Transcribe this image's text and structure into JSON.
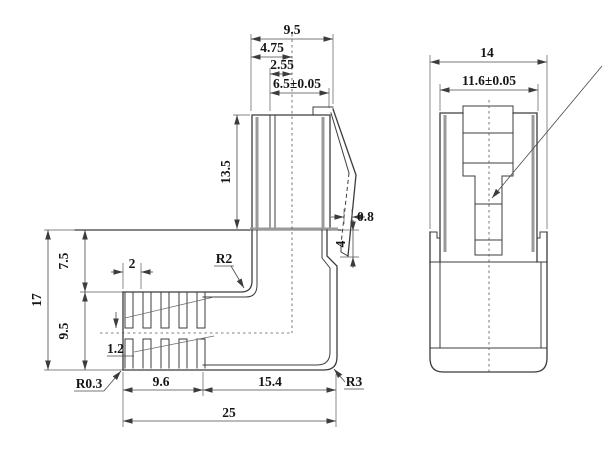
{
  "drawing": {
    "background": "#ffffff",
    "line_color": "#3c3c3c",
    "thick_line_color": "#9a9a9a",
    "text_color": "#161616",
    "side_view": {
      "top_dims": {
        "overall_width": "9.5",
        "half_width": "4.75",
        "center_offset": "2.55",
        "slot_width": "6.5±0.05"
      },
      "plug_height": "13.5",
      "latch_thickness": "0.8",
      "latch_tip_offset": "4",
      "left_dims": {
        "overall_height": "17",
        "upper_height": "7.5",
        "lower_height": "9.5"
      },
      "rib_dims": {
        "pitch": "2",
        "web": "1.2"
      },
      "radii": {
        "corner": "R0.3",
        "inner": "R2",
        "outer": "R3"
      },
      "bottom_dims": {
        "rib_length": "9.6",
        "body_length": "15.4",
        "overall_length": "25"
      }
    },
    "front_view": {
      "overall_width": "14",
      "plug_width": "11.6±0.05"
    }
  }
}
